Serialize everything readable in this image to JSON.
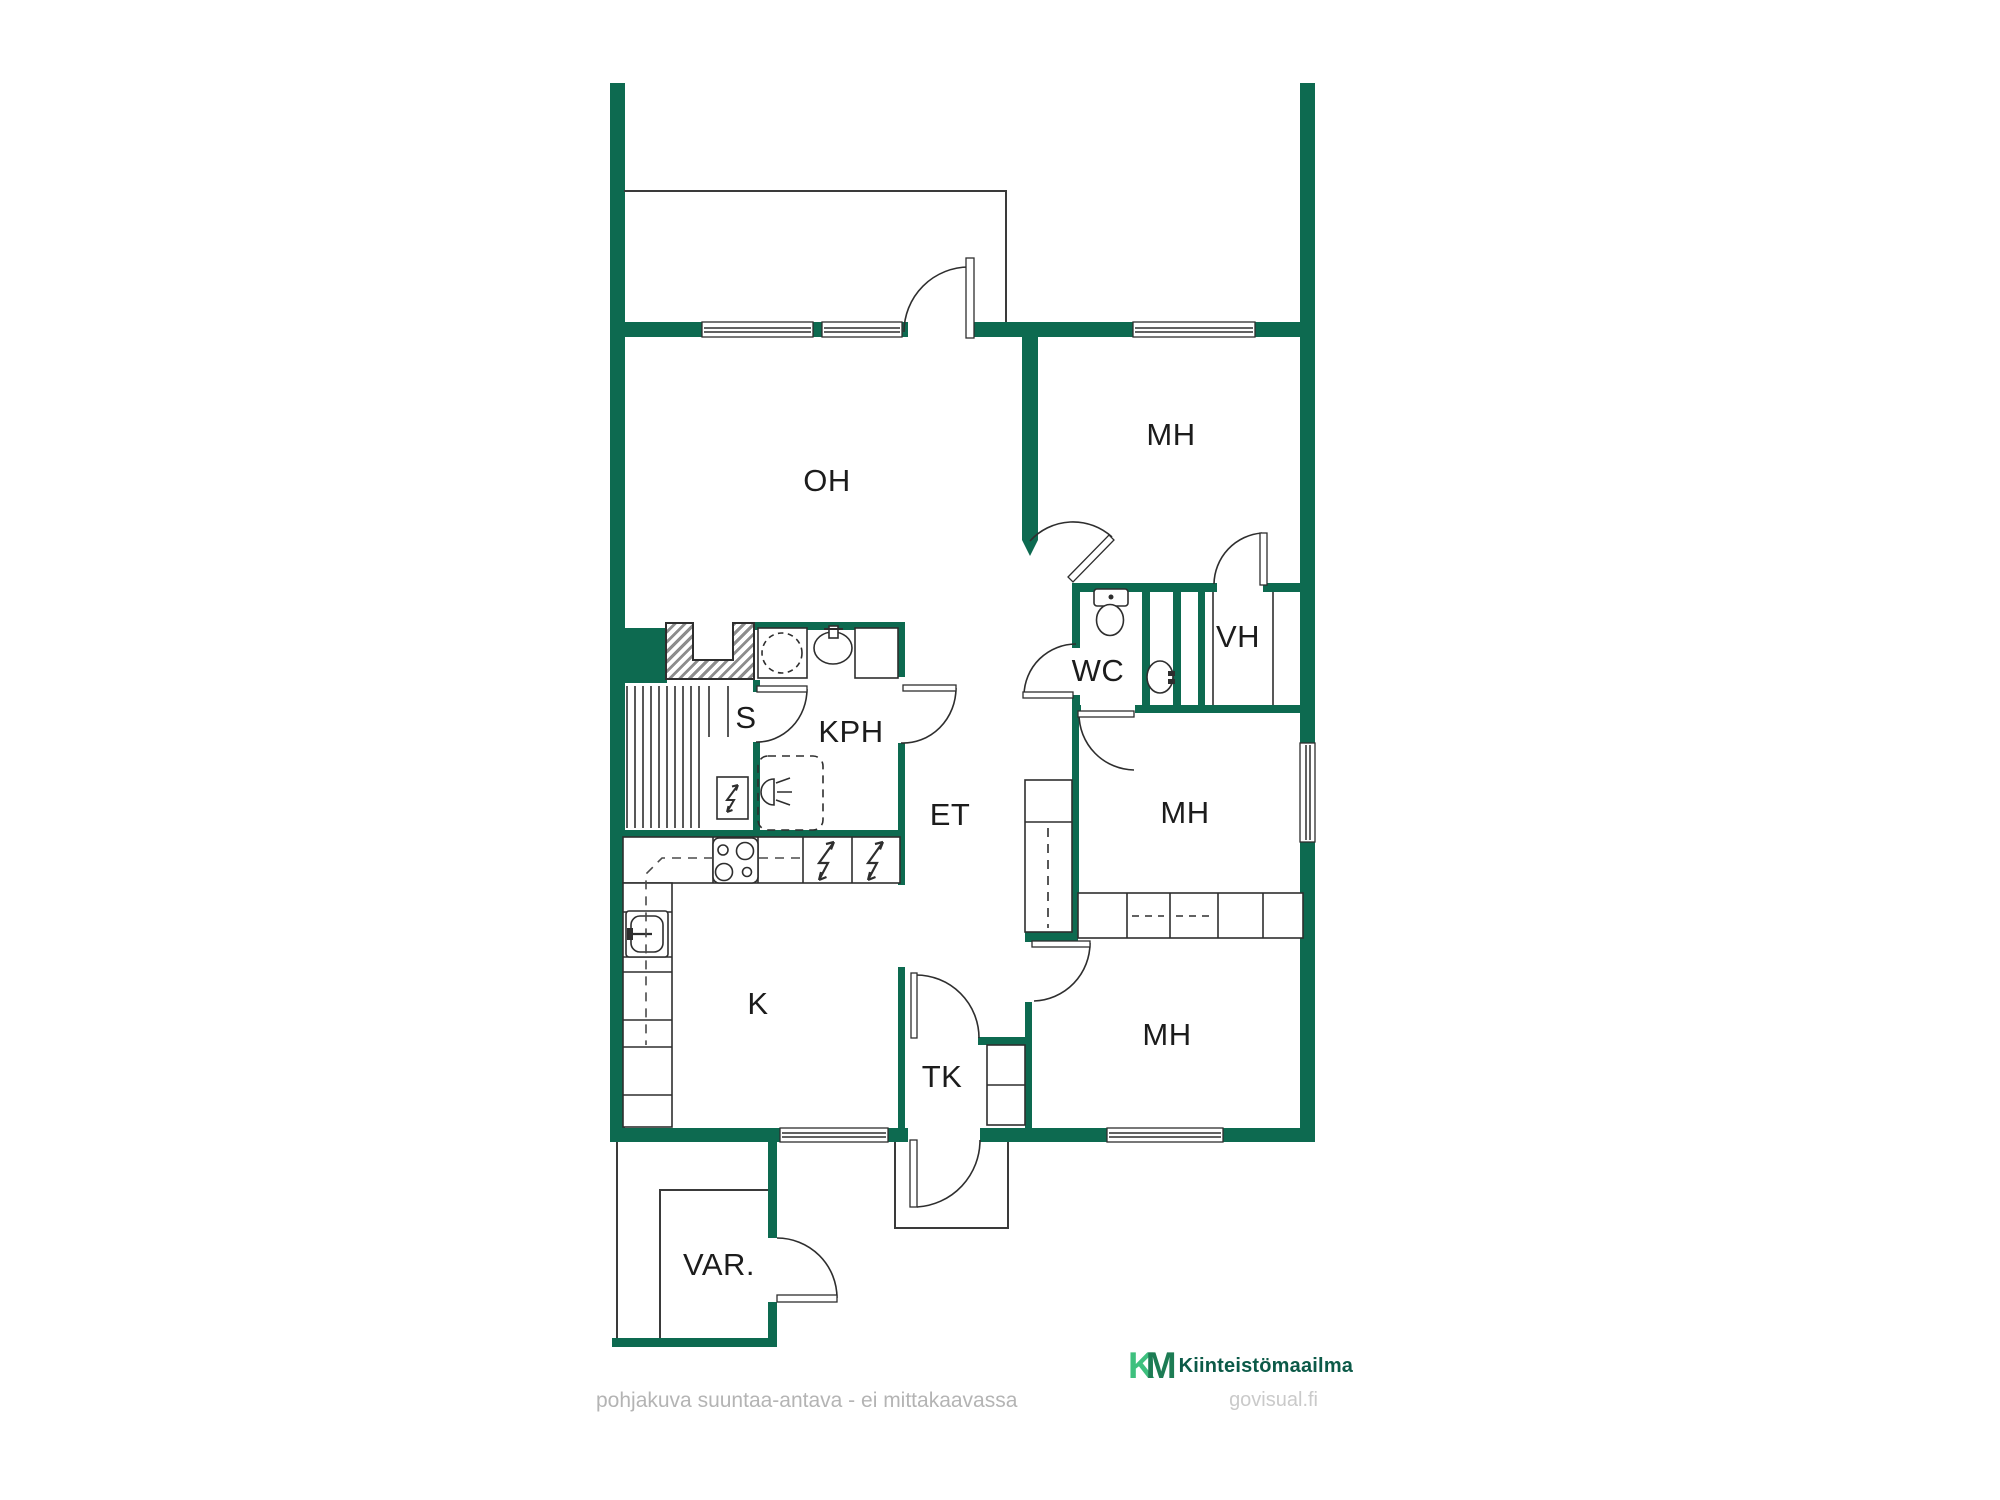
{
  "page": {
    "background": "#ffffff",
    "type": "floor-plan"
  },
  "colors": {
    "wall_green": "#0d6a50",
    "line_dark": "#2e2e2e",
    "label_text": "#1c1c1c",
    "logo_light_green": "#3ec07e",
    "logo_dark_green": "#1d7c54",
    "brand_text_green": "#0c5a48",
    "footer_gray": "#b4b4b4",
    "watermark_gray": "#cacaca"
  },
  "rooms": [
    {
      "id": "living-room",
      "label": "OH"
    },
    {
      "id": "bedroom-top",
      "label": "MH"
    },
    {
      "id": "toilet",
      "label": "WC"
    },
    {
      "id": "closet",
      "label": "VH"
    },
    {
      "id": "sauna",
      "label": "S"
    },
    {
      "id": "bathroom",
      "label": "KPH"
    },
    {
      "id": "entry-hall",
      "label": "ET"
    },
    {
      "id": "bedroom-middle",
      "label": "MH"
    },
    {
      "id": "kitchen",
      "label": "K"
    },
    {
      "id": "bedroom-bottom",
      "label": "MH"
    },
    {
      "id": "vestibule",
      "label": "TK"
    },
    {
      "id": "storage",
      "label": "VAR."
    }
  ],
  "footer": {
    "disclaimer": "pohjakuva suuntaa-antava - ei mittakaavassa"
  },
  "branding": {
    "monogram_k": "K",
    "monogram_m": "M",
    "brand_name": "Kiinteistömaailma",
    "watermark": "govisual.fi"
  }
}
